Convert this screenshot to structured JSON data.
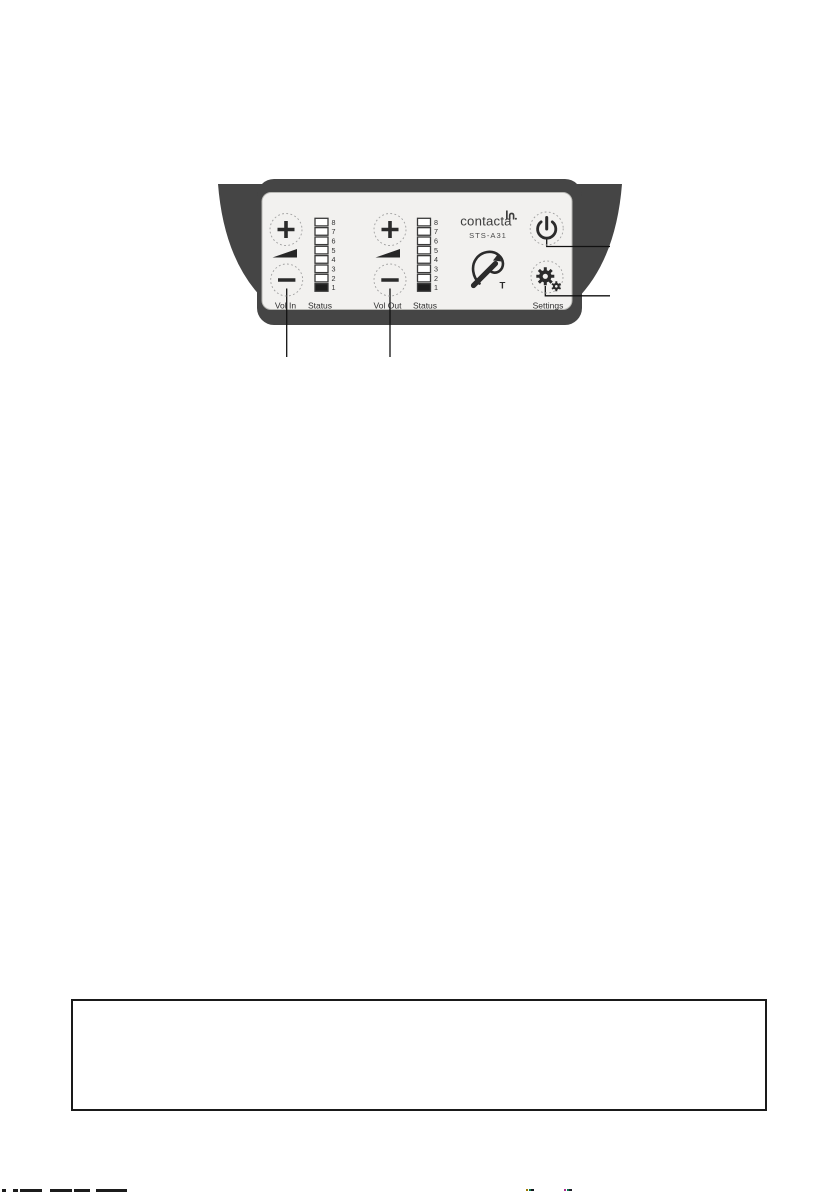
{
  "device": {
    "brand": "contacta",
    "model": "STS-A31",
    "vol_in_label": "Vol In",
    "vol_out_label": "Vol Out",
    "status_in": {
      "label": "Status",
      "levels": [
        "8",
        "7",
        "6",
        "5",
        "4",
        "3",
        "2",
        "1"
      ],
      "lit_level": "1"
    },
    "status_out": {
      "label": "Status",
      "levels": [
        "8",
        "7",
        "6",
        "5",
        "4",
        "3",
        "2",
        "1"
      ],
      "lit_level": "1"
    },
    "settings_label": "Settings",
    "hearing_loop_letter": "T",
    "colors": {
      "body": "#454545",
      "panel": "#f2f1ef",
      "glyph": "#2b2b2b"
    }
  },
  "notes_box": {
    "text": ""
  },
  "footer": {
    "left_fragments_color": "#1c1c1c",
    "accent_fragment_colors": [
      "#a07800",
      "#0a7a50",
      "#16161e",
      "#b03090",
      "#20202a"
    ]
  }
}
